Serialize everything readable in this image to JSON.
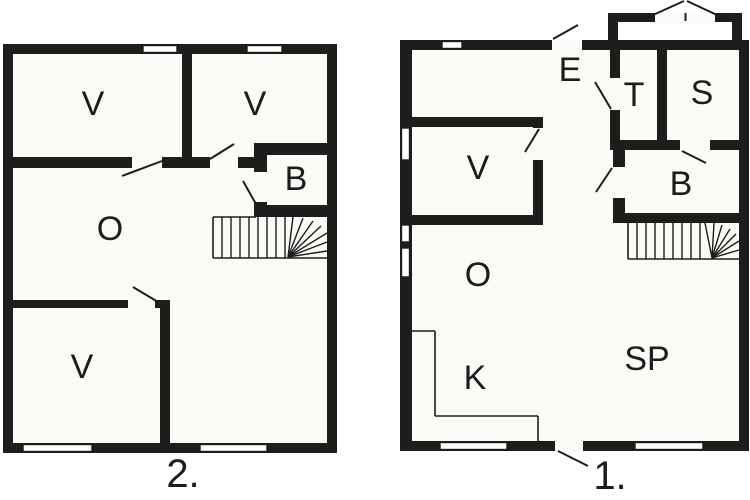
{
  "canvas": {
    "width": 750,
    "height": 500,
    "background": "#ffffff",
    "interior_color": "#fbfaf6",
    "wall_color": "#1f1c1c",
    "line_color": "#1c1c1c",
    "window_fill": "#ffffff",
    "room_font_size": 34,
    "floor_font_size": 40
  },
  "plans": [
    {
      "id": "upper-floor-plan",
      "floor_label": "2.",
      "floor_label_x": 183,
      "floor_label_y": 474,
      "interior": {
        "x": 3,
        "y": 44,
        "w": 334,
        "h": 409
      },
      "room_labels": [
        {
          "text": "V",
          "x": 93,
          "y": 104
        },
        {
          "text": "V",
          "x": 255,
          "y": 104
        },
        {
          "text": "B",
          "x": 296,
          "y": 179
        },
        {
          "text": "O",
          "x": 110,
          "y": 229
        },
        {
          "text": "V",
          "x": 82,
          "y": 367
        }
      ],
      "walls": [
        {
          "x": 3,
          "y": 44,
          "w": 334,
          "h": 10
        },
        {
          "x": 3,
          "y": 443,
          "w": 334,
          "h": 10
        },
        {
          "x": 3,
          "y": 44,
          "w": 10,
          "h": 409
        },
        {
          "x": 327,
          "y": 44,
          "w": 10,
          "h": 409
        },
        {
          "x": 182,
          "y": 54,
          "w": 10,
          "h": 114
        },
        {
          "x": 3,
          "y": 157,
          "w": 255,
          "h": 11
        },
        {
          "x": 254,
          "y": 143,
          "w": 83,
          "h": 12
        },
        {
          "x": 254,
          "y": 143,
          "w": 13,
          "h": 74
        },
        {
          "x": 254,
          "y": 205,
          "w": 83,
          "h": 12
        },
        {
          "x": 3,
          "y": 300,
          "w": 167,
          "h": 8
        },
        {
          "x": 160,
          "y": 300,
          "w": 10,
          "h": 153
        }
      ],
      "door_openings": [
        {
          "x": 132,
          "y": 156,
          "w": 30,
          "h": 13
        },
        {
          "x": 210,
          "y": 156,
          "w": 28,
          "h": 13
        },
        {
          "x": 253,
          "y": 172,
          "w": 15,
          "h": 30
        },
        {
          "x": 128,
          "y": 299,
          "w": 27,
          "h": 10
        }
      ],
      "windows": [
        {
          "x": 143,
          "y": 45.5,
          "w": 34,
          "h": 7
        },
        {
          "x": 247,
          "y": 45.5,
          "w": 35,
          "h": 7
        },
        {
          "x": 23,
          "y": 444.5,
          "w": 69,
          "h": 7
        },
        {
          "x": 200,
          "y": 444.5,
          "w": 67,
          "h": 7
        }
      ],
      "swing_lines": [
        {
          "x1": 122,
          "y1": 176,
          "x2": 162,
          "y2": 161
        },
        {
          "x1": 210,
          "y1": 159,
          "x2": 234,
          "y2": 144
        },
        {
          "x1": 243,
          "y1": 181,
          "x2": 256,
          "y2": 204
        },
        {
          "x1": 133,
          "y1": 287,
          "x2": 158,
          "y2": 302
        }
      ],
      "marks": [],
      "thin_lines": [
        {
          "x1": 213,
          "y1": 217,
          "x2": 213,
          "y2": 258
        },
        {
          "x1": 213,
          "y1": 258,
          "x2": 327,
          "y2": 258
        },
        {
          "x1": 213,
          "y1": 217,
          "x2": 256,
          "y2": 217
        }
      ],
      "stair_treads": [
        {
          "x1": 222,
          "y1": 217,
          "x2": 222,
          "y2": 258
        },
        {
          "x1": 231,
          "y1": 217,
          "x2": 231,
          "y2": 258
        },
        {
          "x1": 240,
          "y1": 217,
          "x2": 240,
          "y2": 258
        },
        {
          "x1": 249,
          "y1": 217,
          "x2": 249,
          "y2": 258
        },
        {
          "x1": 258,
          "y1": 217,
          "x2": 258,
          "y2": 258
        },
        {
          "x1": 267,
          "y1": 217,
          "x2": 267,
          "y2": 258
        },
        {
          "x1": 276,
          "y1": 217,
          "x2": 276,
          "y2": 258
        },
        {
          "x1": 285,
          "y1": 217,
          "x2": 285,
          "y2": 258
        }
      ],
      "stair_fan": [
        {
          "x1": 288,
          "y1": 257,
          "x2": 293,
          "y2": 217
        },
        {
          "x1": 288,
          "y1": 257,
          "x2": 303,
          "y2": 218
        },
        {
          "x1": 288,
          "y1": 257,
          "x2": 313,
          "y2": 221
        },
        {
          "x1": 288,
          "y1": 257,
          "x2": 321,
          "y2": 226
        },
        {
          "x1": 288,
          "y1": 257,
          "x2": 327,
          "y2": 233
        },
        {
          "x1": 288,
          "y1": 257,
          "x2": 327,
          "y2": 242
        },
        {
          "x1": 288,
          "y1": 257,
          "x2": 327,
          "y2": 251
        }
      ]
    },
    {
      "id": "ground-floor-plan",
      "floor_label": "1.",
      "floor_label_x": 610,
      "floor_label_y": 476,
      "interior": {
        "x": 400,
        "y": 40,
        "w": 349,
        "h": 411
      },
      "room_labels": [
        {
          "text": "E",
          "x": 570,
          "y": 70
        },
        {
          "text": "T",
          "x": 634,
          "y": 95
        },
        {
          "text": "S",
          "x": 702,
          "y": 93
        },
        {
          "text": "V",
          "x": 478,
          "y": 168
        },
        {
          "text": "B",
          "x": 681,
          "y": 184
        },
        {
          "text": "O",
          "x": 478,
          "y": 275
        },
        {
          "text": "K",
          "x": 475,
          "y": 378
        },
        {
          "text": "SP",
          "x": 647,
          "y": 359
        }
      ],
      "walls": [
        {
          "x": 400,
          "y": 40,
          "w": 349,
          "h": 10
        },
        {
          "x": 400,
          "y": 441,
          "w": 349,
          "h": 10
        },
        {
          "x": 400,
          "y": 40,
          "w": 12,
          "h": 411
        },
        {
          "x": 739,
          "y": 40,
          "w": 10,
          "h": 411
        },
        {
          "x": 608,
          "y": 13,
          "w": 134,
          "h": 9
        },
        {
          "x": 608,
          "y": 13,
          "w": 10,
          "h": 31
        },
        {
          "x": 732,
          "y": 13,
          "w": 10,
          "h": 31
        },
        {
          "x": 400,
          "y": 117,
          "w": 143,
          "h": 10
        },
        {
          "x": 533,
          "y": 117,
          "w": 10,
          "h": 108
        },
        {
          "x": 400,
          "y": 215,
          "w": 143,
          "h": 10
        },
        {
          "x": 610,
          "y": 50,
          "w": 10,
          "h": 95
        },
        {
          "x": 657,
          "y": 50,
          "w": 10,
          "h": 100
        },
        {
          "x": 610,
          "y": 140,
          "w": 139,
          "h": 10
        },
        {
          "x": 613,
          "y": 140,
          "w": 12,
          "h": 83
        },
        {
          "x": 613,
          "y": 213,
          "w": 136,
          "h": 10
        }
      ],
      "door_openings": [
        {
          "x": 655,
          "y": 12,
          "w": 60,
          "h": 11
        },
        {
          "x": 552,
          "y": 39,
          "w": 30,
          "h": 12
        },
        {
          "x": 609,
          "y": 78,
          "w": 12,
          "h": 32
        },
        {
          "x": 532,
          "y": 128,
          "w": 12,
          "h": 32
        },
        {
          "x": 680,
          "y": 139,
          "w": 30,
          "h": 12
        },
        {
          "x": 612,
          "y": 167,
          "w": 14,
          "h": 31
        },
        {
          "x": 555,
          "y": 440,
          "w": 28,
          "h": 12
        }
      ],
      "windows": [
        {
          "x": 442,
          "y": 41.5,
          "w": 20,
          "h": 7
        },
        {
          "x": 401.5,
          "y": 128,
          "w": 8,
          "h": 32
        },
        {
          "x": 401.5,
          "y": 225,
          "w": 8,
          "h": 17
        },
        {
          "x": 401.5,
          "y": 248,
          "w": 8,
          "h": 29
        },
        {
          "x": 440,
          "y": 442.5,
          "w": 67,
          "h": 7
        },
        {
          "x": 635,
          "y": 442.5,
          "w": 68,
          "h": 7
        }
      ],
      "swing_lines": [
        {
          "x1": 553,
          "y1": 39,
          "x2": 578,
          "y2": 25
        },
        {
          "x1": 595,
          "y1": 82,
          "x2": 611,
          "y2": 109
        },
        {
          "x1": 525,
          "y1": 152,
          "x2": 539,
          "y2": 129
        },
        {
          "x1": 682,
          "y1": 151,
          "x2": 706,
          "y2": 163
        },
        {
          "x1": 596,
          "y1": 192,
          "x2": 612,
          "y2": 168
        }
      ],
      "marks": [
        {
          "x1": 653,
          "y1": 15,
          "x2": 684,
          "y2": 1
        },
        {
          "x1": 687,
          "y1": 1,
          "x2": 717,
          "y2": 15
        },
        {
          "x1": 685.5,
          "y1": 13,
          "x2": 685.5,
          "y2": 21
        },
        {
          "x1": 558,
          "y1": 451,
          "x2": 588,
          "y2": 466
        }
      ],
      "thin_lines": [
        {
          "x1": 412,
          "y1": 331,
          "x2": 435,
          "y2": 331
        },
        {
          "x1": 435,
          "y1": 331,
          "x2": 435,
          "y2": 416
        },
        {
          "x1": 435,
          "y1": 416,
          "x2": 538,
          "y2": 416
        },
        {
          "x1": 538,
          "y1": 416,
          "x2": 538,
          "y2": 441
        },
        {
          "x1": 628,
          "y1": 223,
          "x2": 628,
          "y2": 259
        },
        {
          "x1": 628,
          "y1": 259,
          "x2": 739,
          "y2": 259
        }
      ],
      "stair_treads": [
        {
          "x1": 637,
          "y1": 223,
          "x2": 637,
          "y2": 259
        },
        {
          "x1": 646,
          "y1": 223,
          "x2": 646,
          "y2": 259
        },
        {
          "x1": 655,
          "y1": 223,
          "x2": 655,
          "y2": 259
        },
        {
          "x1": 664,
          "y1": 223,
          "x2": 664,
          "y2": 259
        },
        {
          "x1": 673,
          "y1": 223,
          "x2": 673,
          "y2": 259
        },
        {
          "x1": 682,
          "y1": 223,
          "x2": 682,
          "y2": 259
        },
        {
          "x1": 691,
          "y1": 223,
          "x2": 691,
          "y2": 259
        },
        {
          "x1": 700,
          "y1": 223,
          "x2": 700,
          "y2": 259
        }
      ],
      "stair_fan": [
        {
          "x1": 712,
          "y1": 258,
          "x2": 705,
          "y2": 223
        },
        {
          "x1": 712,
          "y1": 258,
          "x2": 714,
          "y2": 223
        },
        {
          "x1": 712,
          "y1": 258,
          "x2": 722,
          "y2": 225
        },
        {
          "x1": 712,
          "y1": 258,
          "x2": 730,
          "y2": 229
        },
        {
          "x1": 712,
          "y1": 258,
          "x2": 736,
          "y2": 234
        },
        {
          "x1": 712,
          "y1": 258,
          "x2": 739,
          "y2": 241
        },
        {
          "x1": 712,
          "y1": 258,
          "x2": 739,
          "y2": 250
        }
      ]
    }
  ]
}
